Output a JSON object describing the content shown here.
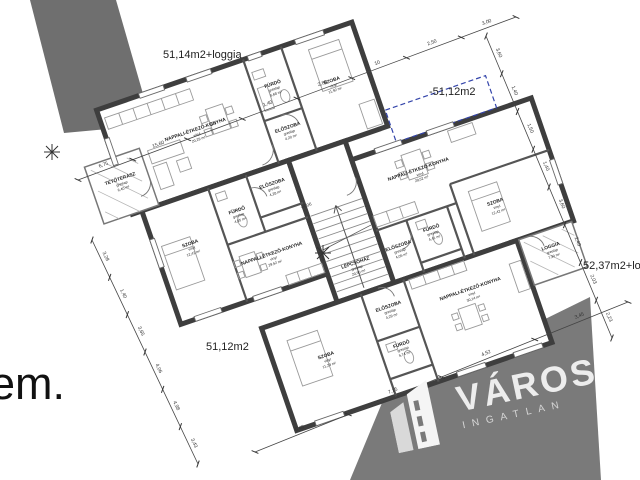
{
  "page": {
    "background": "#ffffff"
  },
  "floor_label": "em.",
  "area_labels": [
    {
      "id": "apartment-area-top",
      "text": "51,14m2+loggia",
      "x": 163,
      "y": 49
    },
    {
      "id": "apartment-area-roof",
      "text": "-51,12m2",
      "x": 429,
      "y": 86
    },
    {
      "id": "apartment-area-right",
      "text": "52,37m2+loggia",
      "x": 583,
      "y": 260
    },
    {
      "id": "apartment-area-bottom",
      "text": "51,12m2",
      "x": 206,
      "y": 341
    }
  ],
  "level_marker": "+4,06",
  "colors": {
    "wall": "#3e3e3e",
    "interior_wall": "#555555",
    "gray_mass": "#6f6f6f",
    "watermark_band": "#7a7a7a",
    "roof_dash": "#3344aa",
    "dim_line": "#444444"
  },
  "watermark": {
    "brand": "VÁROS",
    "sub": "INGATLAN"
  },
  "rooms": [
    {
      "name": "NAPPALI-ÉTKEZŐ-KONYHA",
      "flooring": "vinyl",
      "area": "20,29 m²",
      "x": 62,
      "y": -58
    },
    {
      "name": "FÜRDŐ",
      "flooring": "greslap",
      "area": "5,68 m²",
      "x": 150,
      "y": -76
    },
    {
      "name": "ELŐSZOBA",
      "flooring": "greslap",
      "area": "4,20 m²",
      "x": 150,
      "y": -30
    },
    {
      "name": "SZOBA",
      "flooring": "vinyl",
      "area": "11,92 m²",
      "x": 207,
      "y": -60
    },
    {
      "name": "TETŐTERASZ",
      "flooring": "greslap",
      "area": "6,40 m²",
      "x": -25,
      "y": -36
    },
    {
      "name": "SZOBA",
      "flooring": "vinyl",
      "area": "12,42 m²",
      "x": 20,
      "y": 48
    },
    {
      "name": "FÜRDŐ",
      "flooring": "greslap",
      "area": "4,05 m²",
      "x": 75,
      "y": 32
    },
    {
      "name": "ELŐSZOBA",
      "flooring": "greslap",
      "area": "4,28 m²",
      "x": 117,
      "y": 18
    },
    {
      "name": "NAPPALI-ÉTKEZŐ-KONYHA",
      "flooring": "vinyl",
      "area": "29,52 m²",
      "x": 94,
      "y": 84
    },
    {
      "name": "LÉPCSŐHÁZ",
      "flooring": "greslap",
      "area": "20,50 m²",
      "x": 170,
      "y": 120
    },
    {
      "name": "NAPPALI-ÉTKEZŐ-KONYHA",
      "flooring": "vinyl",
      "area": "29,52 m²",
      "x": 260,
      "y": 52
    },
    {
      "name": "FÜRDŐ",
      "flooring": "greslap",
      "area": "4,41 m²",
      "x": 253,
      "y": 112
    },
    {
      "name": "ELŐSZOBA",
      "flooring": "greslap",
      "area": "4,05 m²",
      "x": 216,
      "y": 118
    },
    {
      "name": "SZOBA",
      "flooring": "vinyl",
      "area": "12,42 m²",
      "x": 322,
      "y": 108
    },
    {
      "name": "LOGGIA",
      "flooring": "greslap",
      "area": "7,30 m²",
      "x": 360,
      "y": 168
    },
    {
      "name": "ELŐSZOBA",
      "flooring": "greslap",
      "area": "4,29 m²",
      "x": 187,
      "y": 172
    },
    {
      "name": "FÜRDŐ",
      "flooring": "greslap",
      "area": "5,74 m²",
      "x": 187,
      "y": 212
    },
    {
      "name": "SZOBA",
      "flooring": "vinyl",
      "area": "11,23 m²",
      "x": 112,
      "y": 198
    },
    {
      "name": "NAPPALI-ÉTKEZŐ-KONYHA",
      "flooring": "vinyl",
      "area": "30,14 m²",
      "x": 270,
      "y": 182
    }
  ],
  "dimensions": {
    "top": [
      "6,75",
      "15,60",
      "50",
      "1,40",
      "2,80",
      "10",
      "2,50",
      "3,00"
    ],
    "right": [
      "3,60",
      "1,40",
      "1,50",
      "1,40",
      "3,60",
      "2,40",
      "2,03",
      "2,23"
    ],
    "left": [
      "3,28",
      "1,40",
      "3,65",
      "4,06",
      "4,98",
      "3,43"
    ],
    "bottom": [
      "5,40",
      "7,15",
      "4,52",
      "3,45"
    ]
  }
}
